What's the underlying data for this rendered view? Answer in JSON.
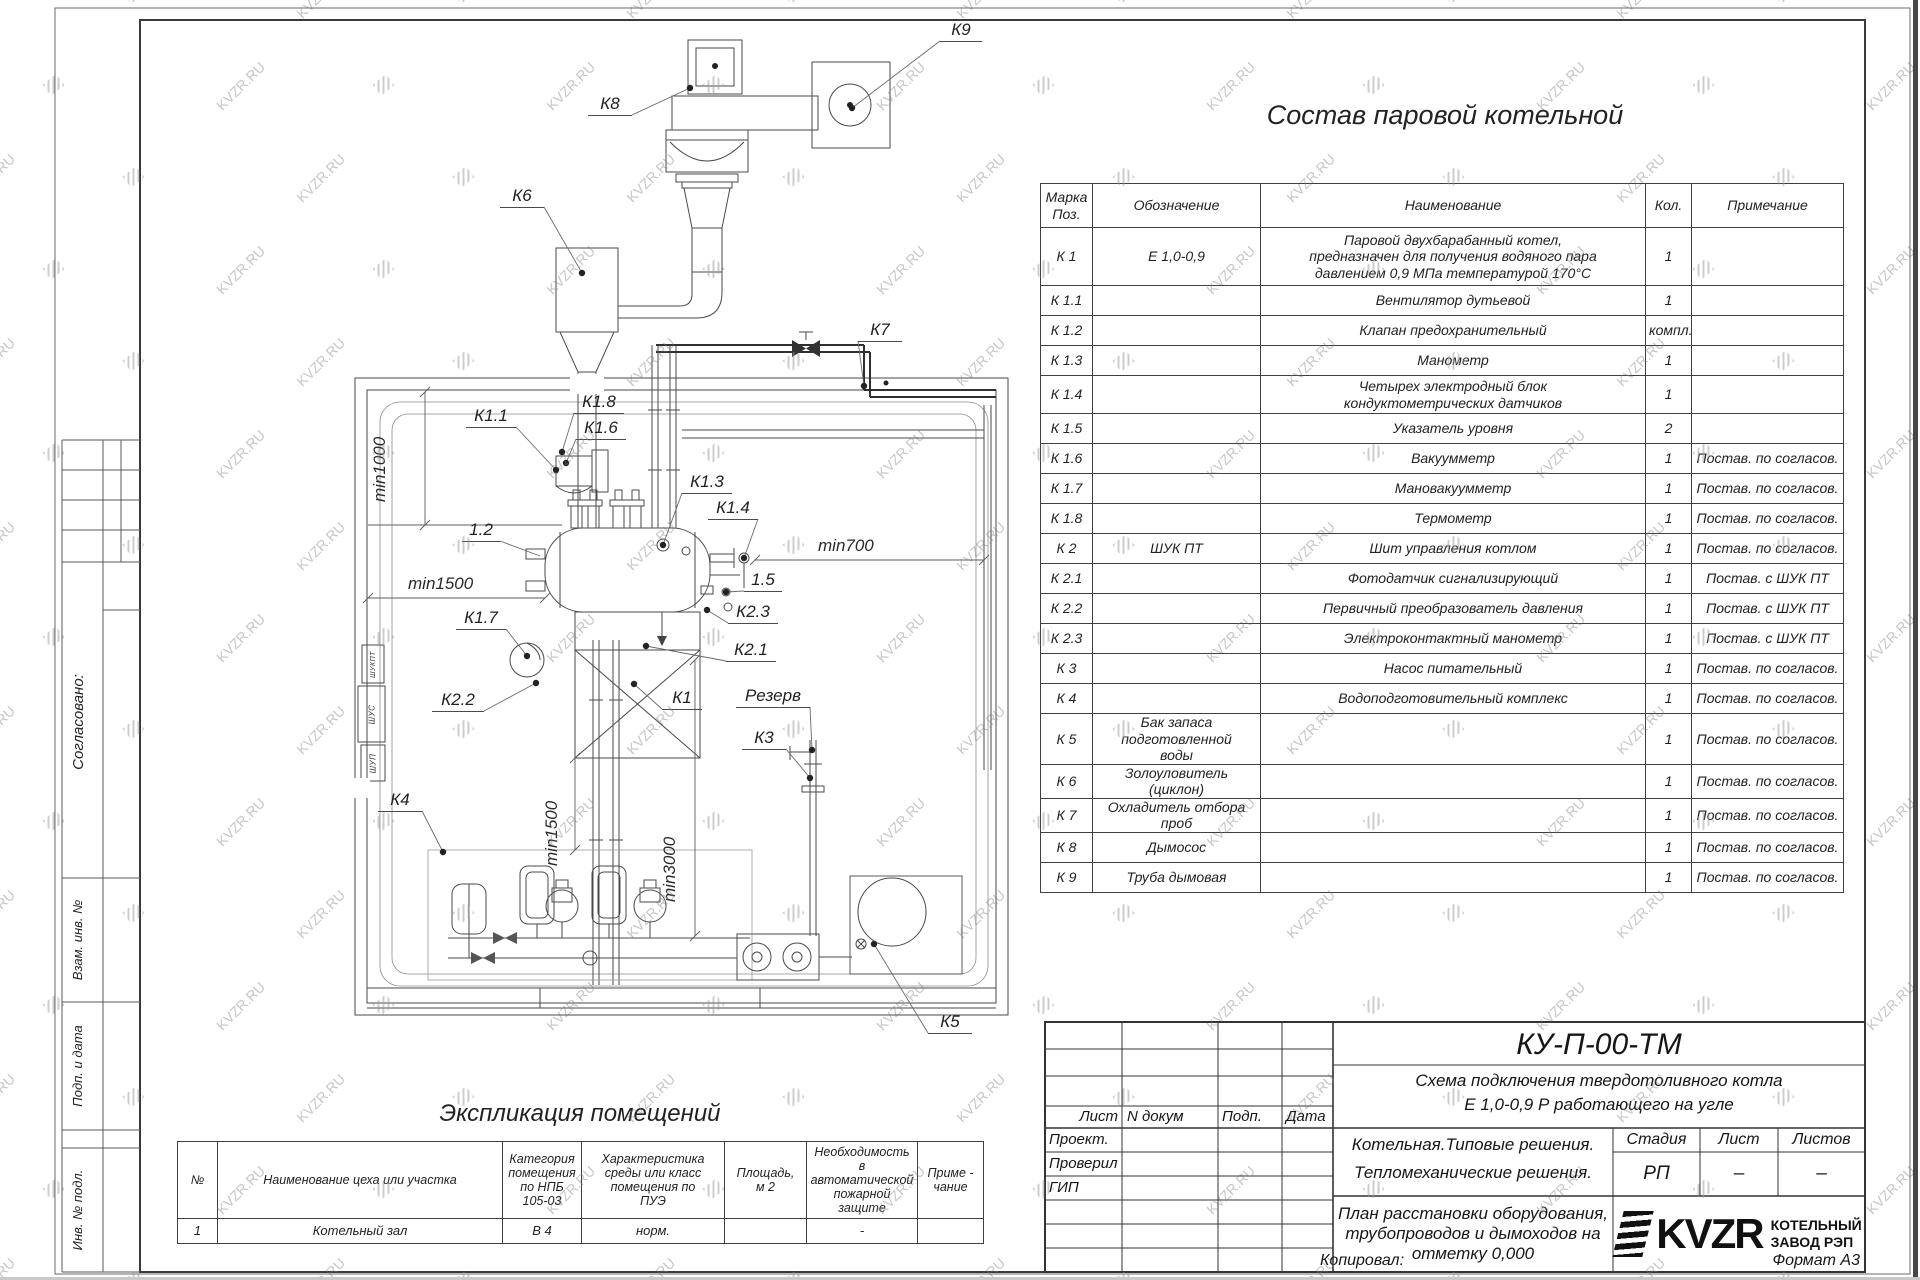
{
  "watermark": {
    "text": "KVZR.RU"
  },
  "stamp": {
    "title": "Состав паровой котельной",
    "headers": [
      "Марка\nПоз.",
      "Обозначение",
      "Наименование",
      "Кол.",
      "Примечание"
    ],
    "rows": [
      [
        "К 1",
        "Е  1,0-0,9",
        "Паровой двухбарабанный котел,\nпредназначен для получения водяного пара\nдавлением 0,9 МПа температурой 170°С",
        "1",
        ""
      ],
      [
        "К 1.1",
        "",
        "Вентилятор дутьевой",
        "1",
        ""
      ],
      [
        "К 1.2",
        "",
        "Клапан предохранительный",
        "компл.",
        ""
      ],
      [
        "К 1.3",
        "",
        "Манометр",
        "1",
        ""
      ],
      [
        "К 1.4",
        "",
        "Четырех электродный блок\nкондуктометрических датчиков",
        "1",
        ""
      ],
      [
        "К 1.5",
        "",
        "Указатель уровня",
        "2",
        ""
      ],
      [
        "К 1.6",
        "",
        "Вакуумметр",
        "1",
        "Постав. по согласов."
      ],
      [
        "К 1.7",
        "",
        "Мановакуумметр",
        "1",
        "Постав. по согласов."
      ],
      [
        "К 1.8",
        "",
        "Термометр",
        "1",
        "Постав. по согласов."
      ],
      [
        "К 2",
        "ШУК ПТ",
        "Шит управления котлом",
        "1",
        "Постав. по согласов."
      ],
      [
        "К 2.1",
        "",
        "Фотодатчик сигнализирующий",
        "1",
        "Постав. с ШУК ПТ"
      ],
      [
        "К 2.2",
        "",
        "Первичный преобразователь давления",
        "1",
        "Постав. с ШУК ПТ"
      ],
      [
        "К 2.3",
        "",
        "Электроконтактный манометр",
        "1",
        "Постав. с ШУК ПТ"
      ],
      [
        "К 3",
        "",
        "Насос питательный",
        "1",
        "Постав. по согласов."
      ],
      [
        "К 4",
        "",
        "Водоподготовительный комплекс",
        "1",
        "Постав. по согласов."
      ],
      [
        "К 5",
        "Бак запаса подготовленной\nводы",
        "",
        "1",
        "Постав. по согласов."
      ],
      [
        "К 6",
        "Золоуловитель  (циклон)",
        "",
        "1",
        "Постав. по согласов."
      ],
      [
        "К 7",
        "Охладитель отбора проб",
        "",
        "1",
        "Постав. по согласов."
      ],
      [
        "К 8",
        "Дымосос",
        "",
        "1",
        "Постав. по согласов."
      ],
      [
        "К 9",
        "Труба дымовая",
        "",
        "1",
        "Постав. по согласов."
      ]
    ]
  },
  "explication": {
    "title": "Экспликация помещений",
    "headers": [
      "№",
      "Наименование цеха или участка",
      "Категория\nпомещения\nпо НПБ\n105-03",
      "Характеристика\nсреды или класс\nпомещения по\nПУЭ",
      "Площадь,\nм 2",
      "Необходимость в\nавтоматической\nпожарной защите",
      "Приме -\nчание"
    ],
    "rows": [
      [
        "1",
        "Котельный зал",
        "В 4",
        "норм.",
        "",
        "-",
        ""
      ]
    ]
  },
  "title_block": {
    "doc_number": "КУ-П-00-ТМ",
    "subtitle1": "Схема подключения твердотоливного котла",
    "subtitle2": "Е 1,0-0,9 Р работающего на угле",
    "col_sheet": "Лист",
    "col_doc": "N докум",
    "col_sign": "Подп.",
    "col_date": "Дата",
    "role1": "Проект.",
    "role2": "Проверил",
    "role3": "ГИП",
    "project1": "Котельная.Типовые решения.",
    "project2": "Тепломеханические решения.",
    "stage_label": "Стадия",
    "sheet_label": "Лист",
    "sheets_label": "Листов",
    "stage": "РП",
    "sheet": "–",
    "sheets": "–",
    "drawing_title": "План расстановки оборудования,\nтрубопроводов и дымоходов на\nотметку  0,000",
    "logo_word": "KVZR",
    "company1": "КОТЕЛЬНЫЙ",
    "company2": "ЗАВОД РЭП",
    "copied": "Копировал:",
    "format": "Формат А3"
  },
  "margin": {
    "agreed": "Согласовано:",
    "vzam": "Взам. инв. №",
    "podp": "Подп. и дата",
    "inv": "Инв. № подл."
  },
  "plan": {
    "labels": [
      {
        "t": "К9",
        "x": 940,
        "y": 20,
        "w": 42,
        "dx": 852,
        "dy": 108
      },
      {
        "t": "К8",
        "x": 588,
        "y": 94,
        "w": 44,
        "dx": 690,
        "dy": 88
      },
      {
        "t": "К6",
        "x": 500,
        "y": 186,
        "w": 44,
        "dx": 582,
        "dy": 273
      },
      {
        "t": "К7",
        "x": 858,
        "y": 320,
        "w": 44,
        "dx": 864,
        "dy": 386
      },
      {
        "t": "К1.8",
        "x": 574,
        "y": 392,
        "w": 50,
        "dx": 562,
        "dy": 452
      },
      {
        "t": "К1.6",
        "x": 576,
        "y": 418,
        "w": 50,
        "dx": 566,
        "dy": 463
      },
      {
        "t": "К1.1",
        "x": 466,
        "y": 406,
        "w": 50,
        "dx": 556,
        "dy": 470
      },
      {
        "t": "К1.3",
        "x": 682,
        "y": 472,
        "w": 50,
        "dx": 663,
        "dy": 545
      },
      {
        "t": "К1.4",
        "x": 708,
        "y": 498,
        "w": 50,
        "dx": 744,
        "dy": 558
      },
      {
        "t": "1.2",
        "x": 462,
        "y": 520,
        "w": 38,
        "dx": 540,
        "dy": 556,
        "nodot": true
      },
      {
        "t": "1.5",
        "x": 744,
        "y": 570,
        "w": 38,
        "dx": 726,
        "dy": 592
      },
      {
        "t": "К2.3",
        "x": 728,
        "y": 602,
        "w": 50,
        "dx": 707,
        "dy": 610
      },
      {
        "t": "К1.7",
        "x": 456,
        "y": 608,
        "w": 50,
        "dx": 527,
        "dy": 656
      },
      {
        "t": "К2.1",
        "x": 726,
        "y": 640,
        "w": 50,
        "dx": 646,
        "dy": 646
      },
      {
        "t": "К2.2",
        "x": 432,
        "y": 690,
        "w": 52,
        "dx": 536,
        "dy": 683
      },
      {
        "t": "К1",
        "x": 662,
        "y": 688,
        "w": 40,
        "dx": 634,
        "dy": 684
      },
      {
        "t": "Резерв",
        "x": 736,
        "y": 686,
        "w": 74,
        "dx": 812,
        "dy": 750
      },
      {
        "t": "К3",
        "x": 742,
        "y": 728,
        "w": 44,
        "dx": 810,
        "dy": 778
      },
      {
        "t": "К4",
        "x": 378,
        "y": 790,
        "w": 44,
        "dx": 443,
        "dy": 852
      },
      {
        "t": "К5",
        "x": 928,
        "y": 1012,
        "w": 44,
        "dx": 874,
        "dy": 944
      }
    ],
    "dims": [
      {
        "t": "min1000",
        "x": 370,
        "y": 502,
        "rot": -90
      },
      {
        "t": "min1500",
        "x": 408,
        "y": 574,
        "rot": 0
      },
      {
        "t": "min700",
        "x": 818,
        "y": 536,
        "rot": 0
      },
      {
        "t": "min1500",
        "x": 542,
        "y": 866,
        "rot": -90
      },
      {
        "t": "min3000",
        "x": 660,
        "y": 902,
        "rot": -90
      }
    ],
    "panels": [
      {
        "t": "ШУКПТ",
        "x": 362,
        "y": 645,
        "w": 22,
        "h": 38
      },
      {
        "t": "ШУС",
        "x": 358,
        "y": 686,
        "w": 27,
        "h": 56
      },
      {
        "t": "ШУП",
        "x": 361,
        "y": 745,
        "w": 24,
        "h": 36
      }
    ]
  }
}
